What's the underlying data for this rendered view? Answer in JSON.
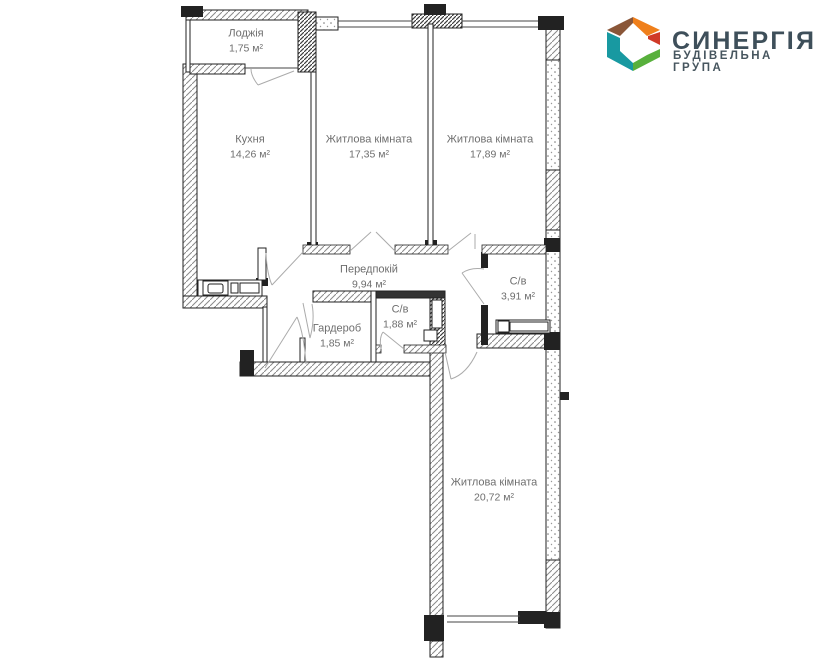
{
  "logo": {
    "brand": "СИНЕРГІЯ",
    "tagline": "БУДІВЕЛЬНА ГРУПА",
    "text_color": "#3e4f5a",
    "cube_colors": {
      "top_left": "#8a5638",
      "top_right": "#ef7f1b",
      "right": "#d03a27",
      "bottom_right": "#58b03c",
      "left": "#1899a1"
    }
  },
  "floor_plan": {
    "unit_suffix": "м²",
    "rooms": [
      {
        "id": "loggia",
        "name": "Лоджія",
        "area": "1,75 м²"
      },
      {
        "id": "kitchen",
        "name": "Кухня",
        "area": "14,26 м²"
      },
      {
        "id": "living-1",
        "name": "Житлова кімната",
        "area": "17,35 м²"
      },
      {
        "id": "living-2",
        "name": "Житлова кімната",
        "area": "17,89 м²"
      },
      {
        "id": "hallway",
        "name": "Передпокій",
        "area": "9,94 м²"
      },
      {
        "id": "bathroom-1",
        "name": "С/в",
        "area": "3,91 м²"
      },
      {
        "id": "wardrobe",
        "name": "Гардероб",
        "area": "1,85 м²"
      },
      {
        "id": "bathroom-2",
        "name": "С/в",
        "area": "1,88 м²"
      },
      {
        "id": "living-3",
        "name": "Житлова кімната",
        "area": "20,72 м²"
      }
    ]
  }
}
